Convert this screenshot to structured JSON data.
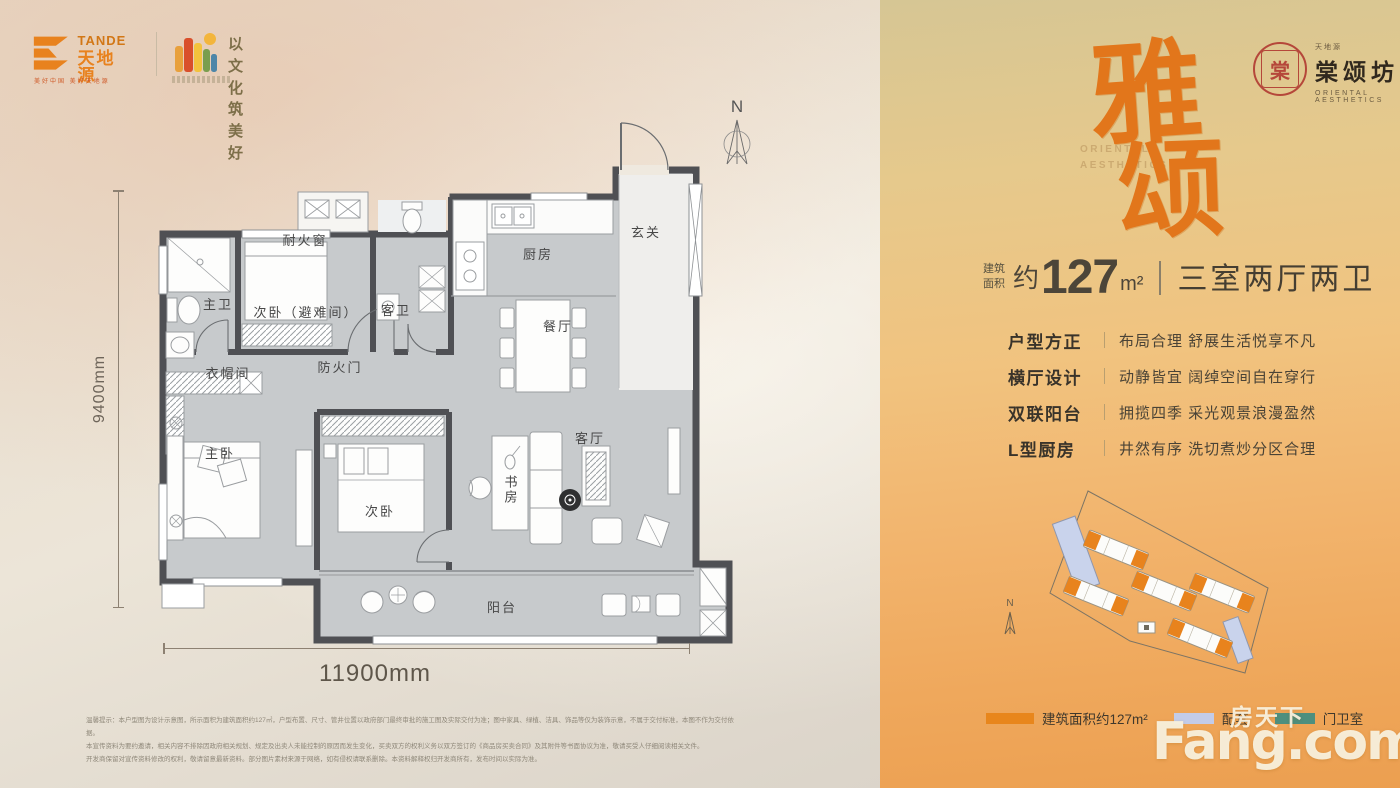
{
  "header": {
    "tande": {
      "en": "TANDE",
      "cn": "天地源",
      "tagline": "美好中国 美好天地源"
    },
    "culture": {
      "line1": "以文化",
      "line2": "筑美好"
    }
  },
  "floorplan": {
    "labels": [
      "主卫",
      "耐火窗",
      "次卧（避难间）",
      "客卫",
      "厨房",
      "玄关",
      "餐厅",
      "防火门",
      "衣帽间",
      "主卧",
      "次卧",
      "书房",
      "客厅",
      "阳台"
    ],
    "dim_height": "9400mm",
    "dim_width": "11900mm",
    "compass": "N",
    "disclaimer": [
      "温馨提示：本户型图为设计示意图，所示面积为建筑面积约127㎡，户型布置、尺寸、管井位置以政府部门最终审批的施工图及实际交付为准；图中家具、绿植、洁具、饰品等仅为装饰示意，不属于交付标准，本图不作为交付依据。",
      "本宣传资料为要约邀请，相关内容不排除因政府相关规划、规定及出卖人未能控制的原因而发生变化，买卖双方的权利义务以双方签订的《商品房买卖合同》及其附件等书面协议为准，敬请买受人仔细阅读相关文件。",
      "开发商保留对宣传资料修改的权利，敬请留意最新资料。部分图片素材来源于网络，如有侵权请联系删除。本资料解释权归开发商所有，发布时间以实际为准。"
    ]
  },
  "panel": {
    "brand": {
      "mini": "天地源",
      "name": "棠颂坊",
      "sub": "ORIENTAL AESTHETICS",
      "seal_char": "棠"
    },
    "title": {
      "char1": "雅",
      "char2": "颂",
      "wm1": "ORIENTAL",
      "wm2": "AESTHETICS"
    },
    "area": {
      "p1": "建筑",
      "p2": "面积",
      "approx": "约",
      "value": "127",
      "unit": "m²",
      "layout": "三室两厅两卫"
    },
    "features": [
      {
        "label": "户型方正",
        "desc": "布局合理 舒展生活悦享不凡"
      },
      {
        "label": "横厅设计",
        "desc": "动静皆宜 阔绰空间自在穿行"
      },
      {
        "label": "双联阳台",
        "desc": "拥揽四季 采光观景浪漫盈然"
      },
      {
        "label": "L型厨房",
        "desc": "井然有序 洗切煮炒分区合理"
      }
    ],
    "legend": [
      {
        "label": "建筑面积约127m²",
        "color": "#e8861c"
      },
      {
        "label": "配套",
        "color": "#c3cce9"
      },
      {
        "label": "门卫室",
        "color": "#4e8f7e"
      }
    ],
    "site_compass": "N"
  },
  "watermark": {
    "cn": "房天下",
    "en": "Fang.com"
  },
  "colors": {
    "accent_orange": "#e8831d",
    "panel_top": "#d6c694",
    "panel_bottom": "#ec9f50",
    "wall": "#4f5054",
    "room_fill": "#c7cacc",
    "lavender": "#c9d3ec",
    "teal": "#4e8f7e",
    "seal_red": "#b5473a"
  }
}
